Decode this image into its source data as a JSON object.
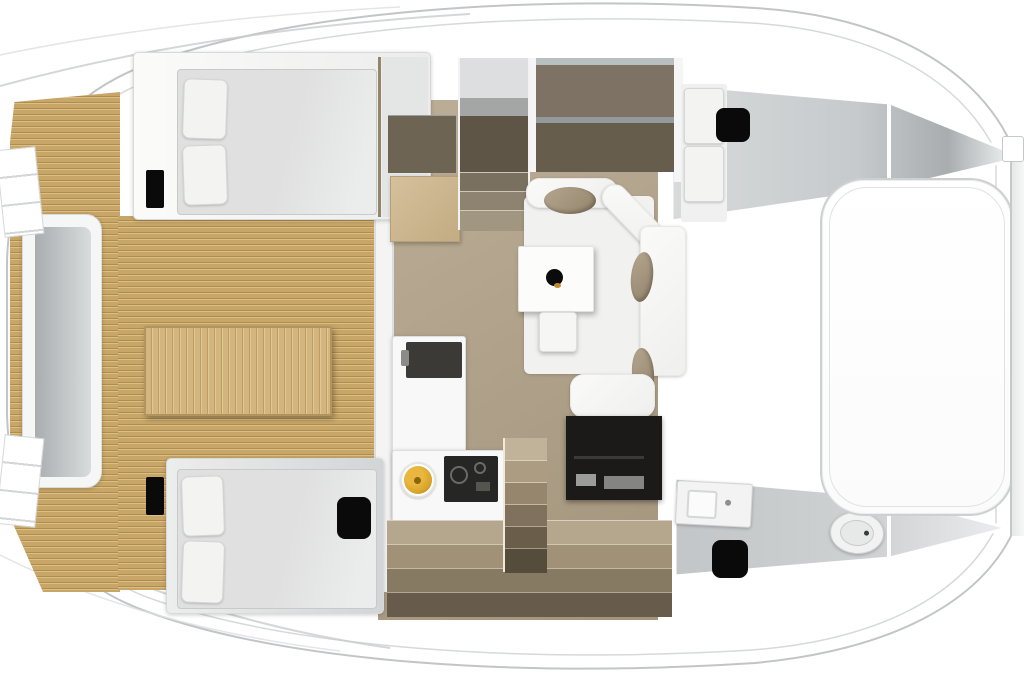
{
  "scene": {
    "title": "Catamaran interior floor plan - top view",
    "canvas": {
      "width_px": 1024,
      "height_px": 680
    },
    "visible_text": []
  },
  "palette": {
    "hull_fill": "#ffffff",
    "hull_stroke": "#c2c5c6",
    "hull_inner_line": "#d6d9da",
    "roof_streak": "#c9cccd",
    "roof_streak_light": "#dcdfe0",
    "teak_base": "#c7a667",
    "teak_seam_dark": "#b18d4d",
    "teak_seam_light": "#dabf88",
    "table_wood": "#d3b67f",
    "salon_floor": "#b3a48c",
    "salon_floor_dark": "#a3947c",
    "cabinet_brown": "#7d7263",
    "cabinet_brown_dark": "#675d4d",
    "stair_shaft_dark": "#5e5546",
    "mattress_gray": "#e2e3e2",
    "pillow_white": "#f3f3f2",
    "sofa_white": "#f7f7f6",
    "cushion_taupe": "#a59681",
    "hatch_black": "#0a0a0a",
    "console_black": "#1b1a19",
    "cooktop_black": "#262624",
    "sink_yellow": "#d9a42b",
    "bench_gray_dark": "#a9adaf",
    "bench_gray_light": "#d9dcdd",
    "wedge_gray_top_start": "#d8dadb",
    "wedge_gray_mid": "#c6cacc",
    "wedge_gray_dark": "#a8adb0",
    "wedge_gray_tip": "#eceeee",
    "bath_floor_start": "#c3c6c8",
    "bath_floor_mid": "#cfd2d3",
    "bath_floor_tip": "#ecedee",
    "fixture_white": "#f2f3f2"
  },
  "areas": {
    "aft_cockpit": "teak cockpit with bench and table",
    "port_aft_cabin": "double berth cabin (upper left)",
    "starboard_aft_cabin": "double berth cabin (lower left)",
    "salon": "dinette sofa with table",
    "galley": "L-shaped galley with sink and cooktop",
    "forward_cabin": "single berth cabin (upper right)",
    "bathroom": "head with vanity and toilet (lower right)",
    "foredeck": "bow sunpad / trampoline (right)"
  },
  "furniture": {
    "items": [
      {
        "name": "stern-bench"
      },
      {
        "name": "transom-steps"
      },
      {
        "name": "cockpit-table"
      },
      {
        "name": "double-bed-port"
      },
      {
        "name": "double-bed-starboard"
      },
      {
        "name": "single-berth-forward"
      },
      {
        "name": "salon-sofa"
      },
      {
        "name": "dinette-table"
      },
      {
        "name": "dinette-stool"
      },
      {
        "name": "galley-counter"
      },
      {
        "name": "galley-sink"
      },
      {
        "name": "galley-cooktop"
      },
      {
        "name": "tv-console"
      },
      {
        "name": "chart-desk"
      },
      {
        "name": "stairs-port-hull"
      },
      {
        "name": "stairs-starboard-hull"
      },
      {
        "name": "vanity-sink"
      },
      {
        "name": "toilet"
      },
      {
        "name": "deck-hatches"
      },
      {
        "name": "bow-sunpad"
      }
    ]
  }
}
